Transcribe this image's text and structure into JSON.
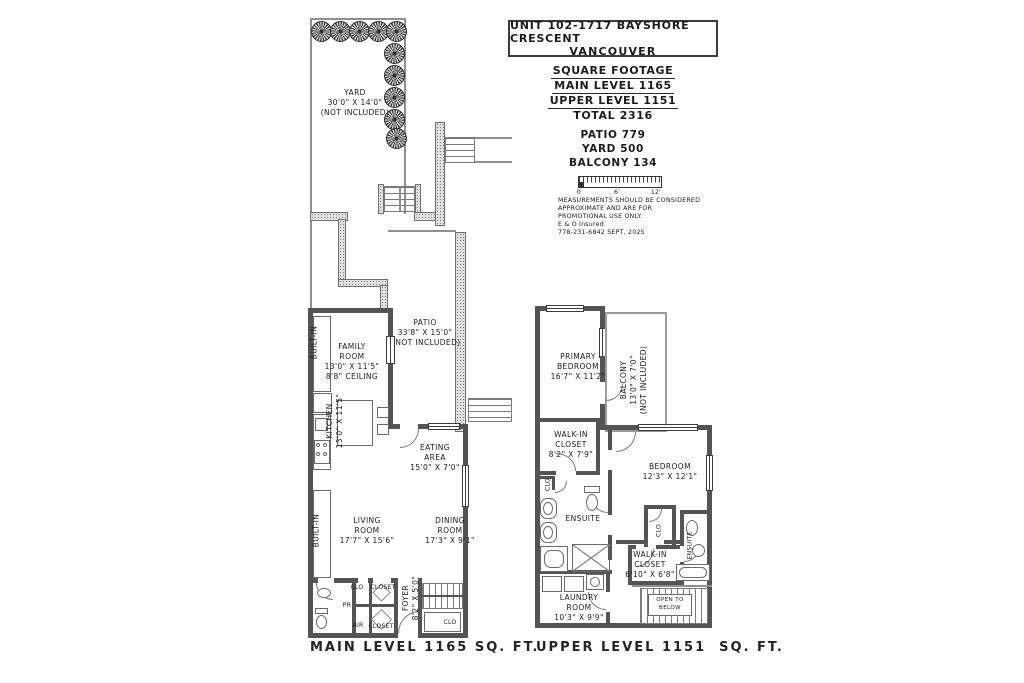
{
  "title_block": {
    "address_line1": "UNIT 102-1717 BAYSHORE CRESCENT",
    "address_line2": "VANCOUVER",
    "sf_header": "SQUARE FOOTAGE",
    "sf_main": "MAIN LEVEL 1165",
    "sf_upper": "UPPER LEVEL 1151",
    "sf_total": "TOTAL 2316",
    "patio_area": "PATIO 779",
    "yard_area": "YARD 500",
    "balcony_area": "BALCONY 134",
    "scale": {
      "zero": "0",
      "six": "6'",
      "twelve": "12'"
    },
    "disclaimer_line1": "MEASUREMENTS SHOULD BE CONSIDERED",
    "disclaimer_line2": "APPROXIMATE AND ARE FOR",
    "disclaimer_line3": "PROMOTIONAL USE ONLY.",
    "disclaimer_line4": "E & O Insured",
    "contact_line": "778-231-6842  SEPT, 2025"
  },
  "main_level": {
    "caption": "MAIN LEVEL 1165 SQ. FT.",
    "yard": {
      "l1": "YARD",
      "l2": "30'0\" X 14'0\"",
      "l3": "(NOT INCLUDED)"
    },
    "patio": {
      "l1": "PATIO",
      "l2": "33'8\" X 15'0\"",
      "l3": "(NOT INCLUDED)"
    },
    "family_room": {
      "l1": "FAMILY",
      "l2": "ROOM",
      "l3": "13'0\" X 11'5\"",
      "l4": "8'8\" CEILING"
    },
    "kitchen": {
      "l1": "KITCHEN",
      "l2": "13'0\" X 11'5\""
    },
    "eating_area": {
      "l1": "EATING",
      "l2": "AREA",
      "l3": "15'0\" X 7'0\""
    },
    "living_room": {
      "l1": "LIVING",
      "l2": "ROOM",
      "l3": "17'7\" X 15'6\""
    },
    "dining_room": {
      "l1": "DINING",
      "l2": "ROOM",
      "l3": "17'3\" X 9'1\""
    },
    "foyer": {
      "l1": "FOYER",
      "l2": "8'2\" X 5'0\""
    },
    "built_in_family": "BUILT-IN",
    "built_in_living": "BUILT-IN",
    "clo_top": "CLO",
    "closet_top": "CLOSET",
    "pr": "PR",
    "air": "AIR",
    "closet_bottom": "CLOSET",
    "clo_stairs": "CLO"
  },
  "upper_level": {
    "caption": "UPPER LEVEL 1151  SQ. FT.",
    "primary_bedroom": {
      "l1": "PRIMARY",
      "l2": "BEDROOM",
      "l3": "16'7\" X 11'2\""
    },
    "balcony": {
      "l1": "BALCONY",
      "l2": "13'0\" X 7'0\"",
      "l3": "(NOT INCLUDED)"
    },
    "walk_in_closet_1": {
      "l1": "WALK-IN",
      "l2": "CLOSET",
      "l3": "8'2\" X 7'9\""
    },
    "bedroom": {
      "l1": "BEDROOM",
      "l2": "12'3\" X 12'1\""
    },
    "ensuite_1": "ENSUITE",
    "ensuite_2": "ENSUITE",
    "clo_left": "CLO",
    "clo_bedroom": "CLO",
    "walk_in_closet_2": {
      "l1": "WALK-IN",
      "l2": "CLOSET",
      "l3": "6'10\" X 6'8\""
    },
    "laundry_room": {
      "l1": "LAUNDRY",
      "l2": "ROOM",
      "l3": "10'3\" X 9'9\""
    },
    "open_to_below": {
      "l1": "OPEN TO",
      "l2": "BELOW"
    }
  },
  "colors": {
    "wall": "#545454",
    "thin_line": "#8f8f8f",
    "stipple_wall": "#e2e2e2",
    "text": "#1c1c1c"
  }
}
